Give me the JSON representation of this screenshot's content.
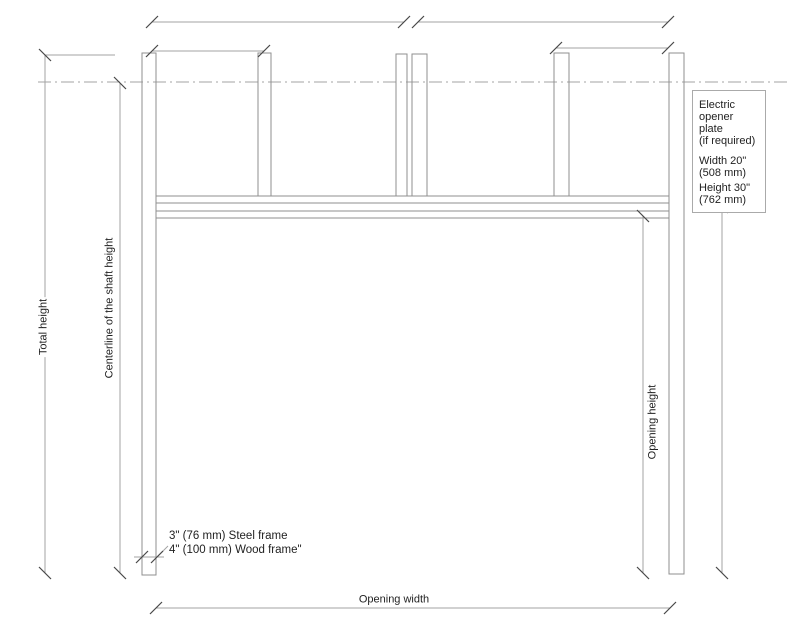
{
  "drawing": {
    "title": "Door opening frame dimension diagram",
    "labels": {
      "total_height": "Total height",
      "centerline_shaft_height": "Centerline of the shaft height",
      "opening_height": "Opening height",
      "opening_width": "Opening width"
    },
    "frame_note": {
      "line1": "3\" (76 mm) Steel frame",
      "line2": "4\" (100 mm) Wood frame\""
    },
    "opener_note": {
      "lines": [
        "Electric",
        "opener plate",
        "(if required)",
        "Width 20\"",
        "(508 mm)",
        "Height 30\"",
        "(762 mm)"
      ]
    },
    "colors": {
      "line": "#a3a3a3",
      "structure": "#8f8f8f",
      "tick": "#474747",
      "text": "#1f1f1f",
      "note_border": "#aaaaaa",
      "background": "#ffffff"
    }
  }
}
